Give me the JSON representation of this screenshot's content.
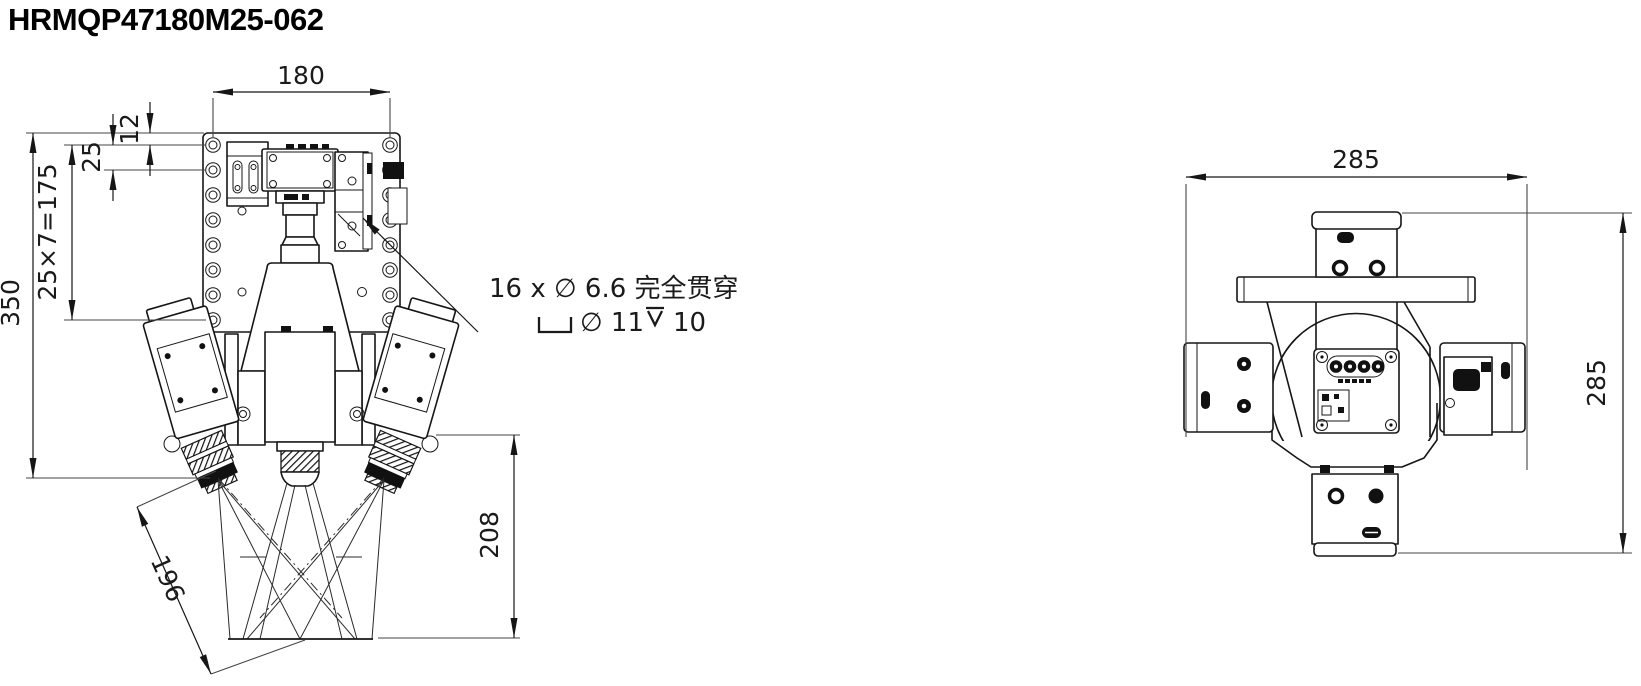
{
  "title": "HRMQP47180M25-062",
  "colors": {
    "line": "#161616",
    "text": "#1a1a1a",
    "background": "#ffffff"
  },
  "front_view": {
    "dims": {
      "top_width": "180",
      "top_offset": "12",
      "hole_pitch": "25",
      "hole_pattern": "25×7=175",
      "overall_height": "350",
      "camera_axis": "196",
      "working_distance": "208"
    },
    "hole_callout": {
      "line1": "16 x ∅ 6.6 完全贯穿",
      "line2_counterbore_dia": "∅ 11",
      "line2_depth": "10"
    }
  },
  "side_view": {
    "dims": {
      "overall_width": "285",
      "overall_height": "285"
    }
  }
}
